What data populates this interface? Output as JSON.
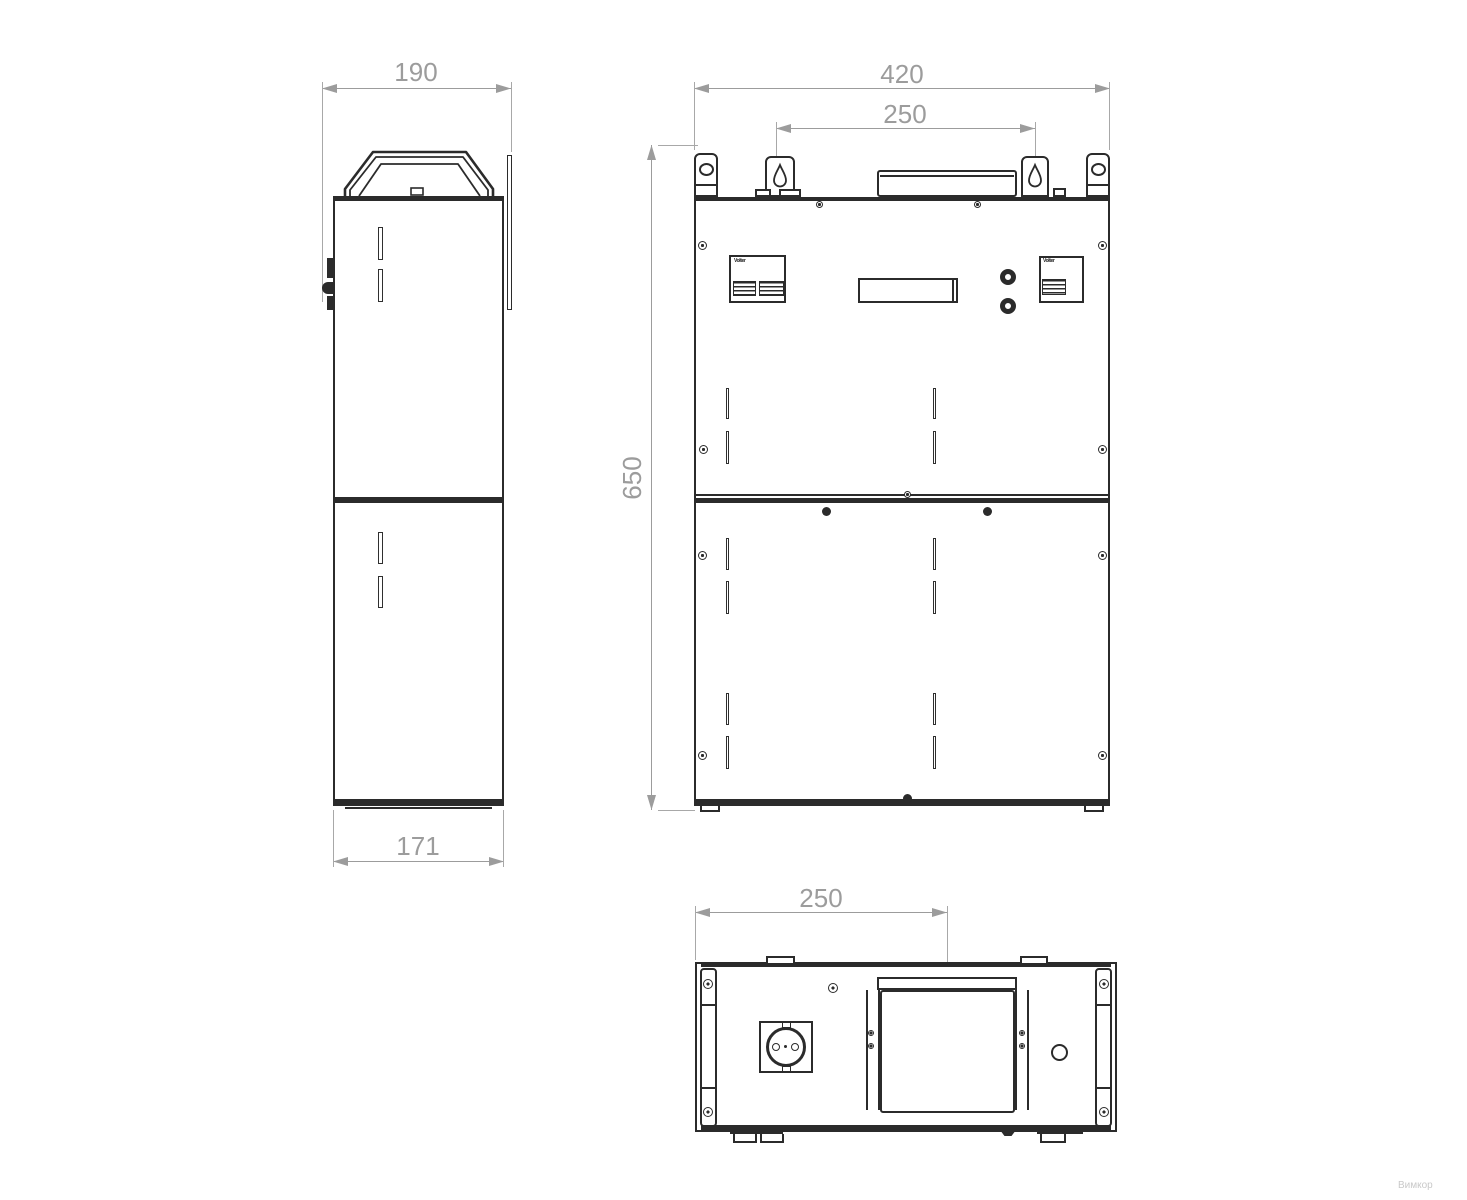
{
  "drawing": {
    "dimensions": {
      "side_width": "190",
      "side_depth": "171",
      "front_width": "420",
      "mount_span": "250",
      "front_height": "650",
      "bottom_offset": "250"
    },
    "brand_mark": "Volter",
    "watermark": "Вимкор",
    "colors": {
      "line": "#2b2b2b",
      "dimension": "#9c9c9c",
      "background": "#ffffff"
    }
  }
}
